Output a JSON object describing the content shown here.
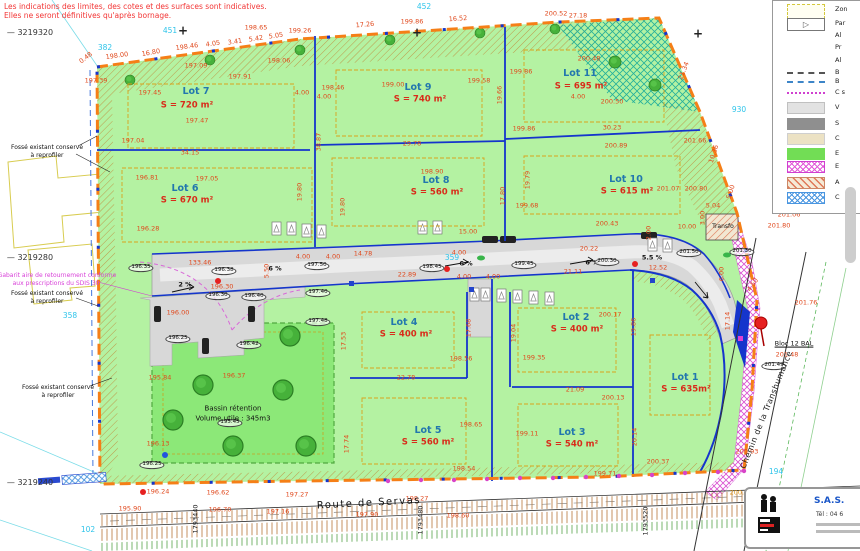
{
  "disclaimer": {
    "line1": "Les indications des limites, des cotes et des surfaces sont indicatives.",
    "line2": "Elles ne seront définitives qu'après bornage."
  },
  "legend": {
    "items": [
      {
        "label": "Zon",
        "sw": "ybox",
        "y": 2
      },
      {
        "label": "Par",
        "sw": "parti",
        "y": 16
      },
      {
        "label": "Al",
        "sw": "none",
        "y": 28
      },
      {
        "label": "Pr",
        "sw": "none",
        "y": 40
      },
      {
        "label": "Al",
        "sw": "none",
        "y": 53
      },
      {
        "label": "B",
        "sw": "gline",
        "y": 65
      },
      {
        "label": "B",
        "sw": "bline",
        "y": 74
      },
      {
        "label": "C s",
        "sw": "mline",
        "y": 85
      },
      {
        "label": "V",
        "sw": "vgray",
        "y": 100
      },
      {
        "label": "S",
        "sw": "sgray",
        "y": 116
      },
      {
        "label": "C",
        "sw": "beige",
        "y": 131
      },
      {
        "label": "E",
        "sw": "green",
        "y": 146
      },
      {
        "label": "E",
        "sw": "xmag",
        "y": 159
      },
      {
        "label": "A",
        "sw": "hred",
        "y": 175
      },
      {
        "label": "C",
        "sw": "xblue",
        "y": 190
      }
    ]
  },
  "logo": {
    "company": "S.A.S.",
    "phone": "Tél : 04 6"
  },
  "map_labels": [
    {
      "t": "0.48",
      "x": 86,
      "y": 58,
      "r": -38
    },
    {
      "t": "198.00",
      "x": 117,
      "y": 56,
      "r": -8
    },
    {
      "t": "16.80",
      "x": 151,
      "y": 53,
      "r": -10
    },
    {
      "t": "198.46",
      "x": 187,
      "y": 47,
      "r": -8
    },
    {
      "t": "4.05",
      "x": 213,
      "y": 44,
      "r": -8
    },
    {
      "t": "3.41",
      "x": 235,
      "y": 42,
      "r": -8
    },
    {
      "t": "5.42",
      "x": 256,
      "y": 39,
      "r": -8
    },
    {
      "t": "5.05",
      "x": 276,
      "y": 36,
      "r": -8
    },
    {
      "t": "198.65",
      "x": 256,
      "y": 28
    },
    {
      "t": "197.39",
      "x": 96,
      "y": 81
    },
    {
      "t": "197.91",
      "x": 240,
      "y": 77
    },
    {
      "t": "197.09",
      "x": 196,
      "y": 66
    },
    {
      "t": "198.06",
      "x": 279,
      "y": 61
    },
    {
      "t": "199.26",
      "x": 300,
      "y": 31
    },
    {
      "t": "17.26",
      "x": 365,
      "y": 25,
      "r": -5
    },
    {
      "t": "199.86",
      "x": 412,
      "y": 22
    },
    {
      "t": "16.52",
      "x": 458,
      "y": 19,
      "r": -4
    },
    {
      "t": "200.52",
      "x": 556,
      "y": 14
    },
    {
      "t": "27.18",
      "x": 578,
      "y": 16
    },
    {
      "t": "197.45",
      "x": 150,
      "y": 93
    },
    {
      "t": "197.47",
      "x": 197,
      "y": 121
    },
    {
      "t": "34.15",
      "x": 190,
      "y": 153
    },
    {
      "t": "196.81",
      "x": 147,
      "y": 178
    },
    {
      "t": "197.05",
      "x": 207,
      "y": 179
    },
    {
      "t": "196.28",
      "x": 148,
      "y": 229
    },
    {
      "t": "197.04",
      "x": 133,
      "y": 141
    },
    {
      "t": "4.00",
      "x": 302,
      "y": 93
    },
    {
      "t": "4.00",
      "x": 324,
      "y": 97
    },
    {
      "t": "38.87",
      "x": 319,
      "y": 142,
      "r": -90
    },
    {
      "t": "19.80",
      "x": 300,
      "y": 192,
      "r": -90
    },
    {
      "t": "19.80",
      "x": 343,
      "y": 207,
      "r": -90
    },
    {
      "t": "198.46",
      "x": 333,
      "y": 88
    },
    {
      "t": "199.00",
      "x": 393,
      "y": 85
    },
    {
      "t": "199.58",
      "x": 479,
      "y": 81
    },
    {
      "t": "29.78",
      "x": 412,
      "y": 144
    },
    {
      "t": "198.90",
      "x": 432,
      "y": 172
    },
    {
      "t": "19.66",
      "x": 500,
      "y": 95,
      "r": -90
    },
    {
      "t": "17.80",
      "x": 503,
      "y": 196,
      "r": -90
    },
    {
      "t": "19.79",
      "x": 528,
      "y": 180,
      "r": -90
    },
    {
      "t": "199.86",
      "x": 521,
      "y": 72
    },
    {
      "t": "200.48",
      "x": 589,
      "y": 59
    },
    {
      "t": "200.50",
      "x": 612,
      "y": 102
    },
    {
      "t": "199.86",
      "x": 524,
      "y": 129
    },
    {
      "t": "30.23",
      "x": 612,
      "y": 128
    },
    {
      "t": "200.89",
      "x": 616,
      "y": 146
    },
    {
      "t": "201.66",
      "x": 695,
      "y": 141
    },
    {
      "t": "201.07",
      "x": 668,
      "y": 189
    },
    {
      "t": "200.80",
      "x": 696,
      "y": 189
    },
    {
      "t": "199.68",
      "x": 527,
      "y": 206
    },
    {
      "t": "200.43",
      "x": 607,
      "y": 224
    },
    {
      "t": "4.00",
      "x": 578,
      "y": 97
    },
    {
      "t": "21.34",
      "x": 684,
      "y": 71,
      "r": -68
    },
    {
      "t": "10.36",
      "x": 714,
      "y": 154,
      "r": -72
    },
    {
      "t": "5.00",
      "x": 731,
      "y": 192,
      "r": -72
    },
    {
      "t": "5.04",
      "x": 713,
      "y": 206
    },
    {
      "t": "3.00",
      "x": 703,
      "y": 218,
      "r": -90
    },
    {
      "t": "10.00",
      "x": 687,
      "y": 227
    },
    {
      "t": "2.00",
      "x": 649,
      "y": 233,
      "r": -90
    },
    {
      "t": "201.06",
      "x": 789,
      "y": 215
    },
    {
      "t": "201.80",
      "x": 779,
      "y": 226
    },
    {
      "t": "201.76",
      "x": 806,
      "y": 303
    },
    {
      "t": "201.48",
      "x": 787,
      "y": 355
    },
    {
      "t": "200.93",
      "x": 747,
      "y": 452
    },
    {
      "t": "133.46",
      "x": 200,
      "y": 263
    },
    {
      "t": "196.30",
      "x": 222,
      "y": 287
    },
    {
      "t": "196.00",
      "x": 178,
      "y": 313
    },
    {
      "t": "5.50",
      "x": 267,
      "y": 271,
      "r": -90
    },
    {
      "t": "15.00",
      "x": 468,
      "y": 232
    },
    {
      "t": "14.78",
      "x": 363,
      "y": 254
    },
    {
      "t": "4.00",
      "x": 303,
      "y": 257
    },
    {
      "t": "4.00",
      "x": 333,
      "y": 257
    },
    {
      "t": "4.00",
      "x": 459,
      "y": 253
    },
    {
      "t": "4.00",
      "x": 464,
      "y": 277
    },
    {
      "t": "4.00",
      "x": 493,
      "y": 277
    },
    {
      "t": "20.22",
      "x": 589,
      "y": 249
    },
    {
      "t": "21.11",
      "x": 573,
      "y": 272
    },
    {
      "t": "12.52",
      "x": 658,
      "y": 268
    },
    {
      "t": "22.89",
      "x": 407,
      "y": 275
    },
    {
      "t": "6.00",
      "x": 722,
      "y": 274,
      "r": -90
    },
    {
      "t": "4.50",
      "x": 753,
      "y": 285,
      "r": -55
    },
    {
      "t": "2 %",
      "x": 185,
      "y": 285,
      "k": "pct"
    },
    {
      "t": "6 %",
      "x": 275,
      "y": 269,
      "k": "pct"
    },
    {
      "t": "6 %",
      "x": 466,
      "y": 264,
      "k": "pct"
    },
    {
      "t": "6 %",
      "x": 592,
      "y": 263,
      "k": "pct"
    },
    {
      "t": "5.5 %",
      "x": 652,
      "y": 258,
      "k": "pct"
    },
    {
      "t": "196.35",
      "x": 141,
      "y": 268,
      "k": "spot"
    },
    {
      "t": "196.38",
      "x": 224,
      "y": 271,
      "k": "spot"
    },
    {
      "t": "196.30",
      "x": 218,
      "y": 296,
      "k": "spot"
    },
    {
      "t": "196.40",
      "x": 254,
      "y": 297,
      "k": "spot"
    },
    {
      "t": "197.40",
      "x": 318,
      "y": 293,
      "k": "spot"
    },
    {
      "t": "197.48",
      "x": 318,
      "y": 322,
      "k": "spot"
    },
    {
      "t": "196.25",
      "x": 178,
      "y": 339,
      "k": "spot"
    },
    {
      "t": "196.42",
      "x": 249,
      "y": 345,
      "k": "spot"
    },
    {
      "t": "195.45",
      "x": 230,
      "y": 423,
      "k": "spot"
    },
    {
      "t": "196.25",
      "x": 152,
      "y": 465,
      "k": "spot"
    },
    {
      "t": "198.45",
      "x": 432,
      "y": 268,
      "k": "spot"
    },
    {
      "t": "199.45",
      "x": 524,
      "y": 265,
      "k": "spot"
    },
    {
      "t": "200.30",
      "x": 607,
      "y": 262,
      "k": "spot"
    },
    {
      "t": "197.50",
      "x": 317,
      "y": 266,
      "k": "spot"
    },
    {
      "t": "201.50",
      "x": 689,
      "y": 253,
      "k": "spot"
    },
    {
      "t": "201.30",
      "x": 742,
      "y": 252,
      "k": "spot"
    },
    {
      "t": "201.49",
      "x": 774,
      "y": 366,
      "k": "spot"
    },
    {
      "t": "195.84",
      "x": 160,
      "y": 378
    },
    {
      "t": "196.13",
      "x": 158,
      "y": 444
    },
    {
      "t": "196.37",
      "x": 234,
      "y": 376
    },
    {
      "t": "17.53",
      "x": 344,
      "y": 341,
      "r": -90
    },
    {
      "t": "17.74",
      "x": 347,
      "y": 444,
      "r": -90
    },
    {
      "t": "198.56",
      "x": 461,
      "y": 359
    },
    {
      "t": "22.78",
      "x": 406,
      "y": 378
    },
    {
      "t": "199.35",
      "x": 534,
      "y": 358
    },
    {
      "t": "200.17",
      "x": 610,
      "y": 315
    },
    {
      "t": "21.09",
      "x": 575,
      "y": 390
    },
    {
      "t": "200.13",
      "x": 613,
      "y": 398
    },
    {
      "t": "199.11",
      "x": 527,
      "y": 434
    },
    {
      "t": "198.65",
      "x": 471,
      "y": 425
    },
    {
      "t": "198.54",
      "x": 464,
      "y": 469
    },
    {
      "t": "199.71",
      "x": 605,
      "y": 474
    },
    {
      "t": "200.37",
      "x": 658,
      "y": 462
    },
    {
      "t": "20.14",
      "x": 635,
      "y": 437,
      "r": -90
    },
    {
      "t": "19.86",
      "x": 634,
      "y": 327,
      "r": -90
    },
    {
      "t": "17.68",
      "x": 469,
      "y": 328,
      "r": -90
    },
    {
      "t": "19.04",
      "x": 514,
      "y": 333,
      "r": -90
    },
    {
      "t": "17.14",
      "x": 728,
      "y": 321,
      "r": -90
    },
    {
      "t": "196.24",
      "x": 158,
      "y": 492
    },
    {
      "t": "196.62",
      "x": 218,
      "y": 493
    },
    {
      "t": "197.27",
      "x": 297,
      "y": 495
    },
    {
      "t": "198.27",
      "x": 417,
      "y": 499
    },
    {
      "t": "195.90",
      "x": 130,
      "y": 509
    },
    {
      "t": "196.70",
      "x": 220,
      "y": 510
    },
    {
      "t": "197.16",
      "x": 278,
      "y": 512
    },
    {
      "t": "197.90",
      "x": 367,
      "y": 515
    },
    {
      "t": "198.60",
      "x": 458,
      "y": 516
    },
    {
      "t": "200.84",
      "x": 741,
      "y": 493,
      "k": "dimo"
    },
    {
      "t": "1793440",
      "x": 196,
      "y": 519,
      "r": -90,
      "k": "dimb"
    },
    {
      "t": "1793480",
      "x": 421,
      "y": 520,
      "r": -90,
      "k": "dimb"
    },
    {
      "t": "1793520",
      "x": 646,
      "y": 521,
      "r": -90,
      "k": "dimb"
    },
    {
      "t": "— 3219320",
      "x": 30,
      "y": 33,
      "k": "coord"
    },
    {
      "t": "— 3219280",
      "x": 30,
      "y": 258,
      "k": "coord"
    },
    {
      "t": "— 3219240",
      "x": 30,
      "y": 483,
      "k": "coord"
    },
    {
      "t": "382",
      "x": 105,
      "y": 48,
      "k": "cyan"
    },
    {
      "t": "451",
      "x": 170,
      "y": 31,
      "k": "cyan"
    },
    {
      "t": "452",
      "x": 424,
      "y": 7,
      "k": "cyan"
    },
    {
      "t": "930",
      "x": 739,
      "y": 110,
      "k": "cyan"
    },
    {
      "t": "359",
      "x": 452,
      "y": 258,
      "k": "cyan"
    },
    {
      "t": "358",
      "x": 70,
      "y": 316,
      "k": "cyan"
    },
    {
      "t": "102",
      "x": 88,
      "y": 530,
      "k": "cyan"
    },
    {
      "t": "194",
      "x": 776,
      "y": 472,
      "k": "cyan"
    },
    {
      "t": "+",
      "x": 183,
      "y": 31,
      "k": "cross"
    },
    {
      "t": "+",
      "x": 417,
      "y": 33,
      "k": "cross"
    },
    {
      "t": "+",
      "x": 698,
      "y": 34,
      "k": "cross"
    },
    {
      "t": "Lot 7",
      "x": 196,
      "y": 92,
      "k": "lot",
      "n": "lot-7-label"
    },
    {
      "t": "S = 720 m²",
      "x": 187,
      "y": 106,
      "k": "area",
      "n": "lot-7-area"
    },
    {
      "t": "Lot 6",
      "x": 185,
      "y": 189,
      "k": "lot",
      "n": "lot-6-label"
    },
    {
      "t": "S = 670 m²",
      "x": 187,
      "y": 201,
      "k": "area",
      "n": "lot-6-area"
    },
    {
      "t": "Lot 9",
      "x": 418,
      "y": 88,
      "k": "lot",
      "n": "lot-9-label"
    },
    {
      "t": "S = 740 m²",
      "x": 420,
      "y": 100,
      "k": "area",
      "n": "lot-9-area"
    },
    {
      "t": "Lot 8",
      "x": 436,
      "y": 181,
      "k": "lot",
      "n": "lot-8-label"
    },
    {
      "t": "S = 560 m²",
      "x": 437,
      "y": 193,
      "k": "area",
      "n": "lot-8-area"
    },
    {
      "t": "Lot 11",
      "x": 580,
      "y": 74,
      "k": "lot",
      "n": "lot-11-label"
    },
    {
      "t": "S = 695 m²",
      "x": 581,
      "y": 87,
      "k": "area",
      "n": "lot-11-area"
    },
    {
      "t": "Lot 10",
      "x": 626,
      "y": 180,
      "k": "lot",
      "n": "lot-10-label"
    },
    {
      "t": "S = 615 m²",
      "x": 627,
      "y": 192,
      "k": "area",
      "n": "lot-10-area"
    },
    {
      "t": "Lot 4",
      "x": 404,
      "y": 323,
      "k": "lot",
      "n": "lot-4-label"
    },
    {
      "t": "S = 400 m²",
      "x": 406,
      "y": 335,
      "k": "area",
      "n": "lot-4-area"
    },
    {
      "t": "Lot 2",
      "x": 576,
      "y": 318,
      "k": "lot",
      "n": "lot-2-label"
    },
    {
      "t": "S = 400 m²",
      "x": 577,
      "y": 330,
      "k": "area",
      "n": "lot-2-area"
    },
    {
      "t": "Lot 5",
      "x": 428,
      "y": 431,
      "k": "lot",
      "n": "lot-5-label"
    },
    {
      "t": "S = 560 m²",
      "x": 428,
      "y": 443,
      "k": "area",
      "n": "lot-5-area"
    },
    {
      "t": "Lot 3",
      "x": 572,
      "y": 433,
      "k": "lot",
      "n": "lot-3-label"
    },
    {
      "t": "S = 540 m²",
      "x": 572,
      "y": 445,
      "k": "area",
      "n": "lot-3-area"
    },
    {
      "t": "Lot 1",
      "x": 685,
      "y": 378,
      "k": "lot",
      "n": "lot-1-label"
    },
    {
      "t": "S = 635m²",
      "x": 686,
      "y": 390,
      "k": "area",
      "n": "lot-1-area"
    },
    {
      "t": "Fossé existant conservé",
      "x": 47,
      "y": 148,
      "k": "note"
    },
    {
      "t": "à reprofiler",
      "x": 47,
      "y": 156,
      "k": "note"
    },
    {
      "t": "Fossé existant conservé",
      "x": 47,
      "y": 294,
      "k": "note"
    },
    {
      "t": "à reprofiler",
      "x": 47,
      "y": 302,
      "k": "note"
    },
    {
      "t": "Fossé existant conservé",
      "x": 58,
      "y": 388,
      "k": "note"
    },
    {
      "t": "à reprofiler",
      "x": 58,
      "y": 396,
      "k": "note"
    },
    {
      "t": "Bassin rétention",
      "x": 233,
      "y": 409,
      "k": "note7"
    },
    {
      "t": "Volume utile : 345m3",
      "x": 233,
      "y": 419,
      "k": "note7"
    },
    {
      "t": "Transfo",
      "x": 723,
      "y": 227,
      "k": "note"
    },
    {
      "t": "Bloc 12 BAL",
      "x": 794,
      "y": 344,
      "k": "noteu"
    },
    {
      "t": "Gabarit aire de retournement conforme",
      "x": 57,
      "y": 276,
      "k": "mag"
    },
    {
      "t": "aux prescriptions du SDIS 30",
      "x": 56,
      "y": 284,
      "k": "mag"
    },
    {
      "t": "Route de Servas",
      "x": 369,
      "y": 504,
      "k": "road9",
      "r": -3
    },
    {
      "t": "Chemin de la Transhumance",
      "x": 767,
      "y": 410,
      "k": "road8",
      "r": -68
    }
  ]
}
